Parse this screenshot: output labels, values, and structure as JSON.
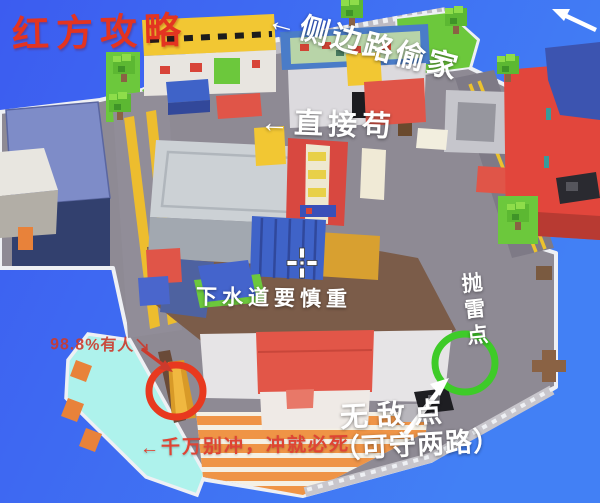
{
  "window": {
    "width": 600,
    "height": 503,
    "scene": "voxel-city-battle-map"
  },
  "guide": {
    "title": "红方攻略",
    "annotations": {
      "side_route": "←侧边路偷家",
      "direct_camp": "←直接苟",
      "sewer_warning": "下水道要慎重",
      "grenade_point": "抛雷点",
      "invincible_point": "无敌点",
      "invincible_note": "（可守两路）",
      "enemy_presence": "98.8%有人↘",
      "rush_warning": "←千万别冲，冲就必死"
    }
  },
  "colors": {
    "water_top": "#3c5cf0",
    "water_right": "#4280f5",
    "title_red": "#e33421",
    "warning_red": "#df4434",
    "enemy_red": "#cc3a2c",
    "annotation_white": "#ffffff",
    "circle_red": "#e8391f",
    "circle_green": "#3ecb28",
    "road_gray": "#8e8a94",
    "road_light": "#bcbac2",
    "fence_white": "#eef0f4",
    "dirt_brown": "#7b5c49",
    "grass_green": "#6cc83c",
    "tree_light": "#8edd4a",
    "tree_dark": "#3f9428",
    "trunk_brown": "#8a6244",
    "pool_cyan": "#aef2ec",
    "plaza_cream": "#f5f0e4",
    "plaza_orange": "#ef9446",
    "building_yellow": "#f2c733",
    "building_red": "#e05548",
    "building_red_big": "#e2463c",
    "building_blue": "#3f63c8",
    "navy_wall": "#32406e",
    "navy_roof": "#7e8cc8",
    "salmon_roof": "#e25648",
    "white_building": "#e6e4e6",
    "gold_box": "#d8a030",
    "orange_block": "#e8823a",
    "cream_tower": "#f0ead6"
  }
}
